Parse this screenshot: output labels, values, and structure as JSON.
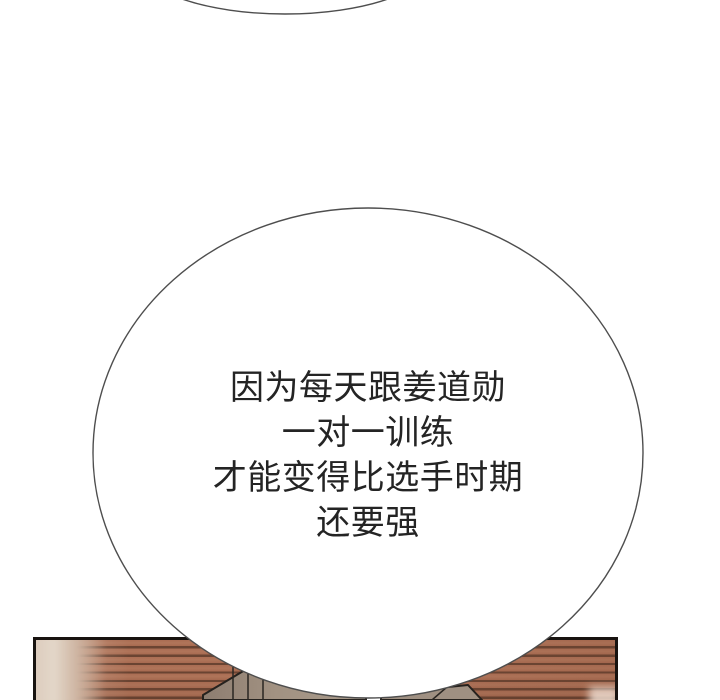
{
  "page": {
    "background_color": "#ffffff"
  },
  "top_bubble": {
    "description_icon": "partial-speech-bubble-bottom-edge",
    "fill": "#ffffff",
    "outline_color": "#4e4e4e"
  },
  "speech_bubble": {
    "lines": [
      "因为每天跟姜道勋",
      "一对一训练",
      "才能变得比选手时期",
      "还要强"
    ],
    "text_color": "#242424",
    "fill": "#ffffff",
    "outline_color": "#4e4e4e"
  },
  "panel": {
    "border_color": "#181310",
    "wall_stripe_base": "#a76a50",
    "wall_stripe_dark": "#6a4432",
    "blur_band_color": "#dccbbc",
    "couch_fill": "#a29282",
    "couch_fill_dark": "#8d7d70",
    "couch_outline": "#26221e",
    "corner_glow_color": "#ecdacd"
  }
}
